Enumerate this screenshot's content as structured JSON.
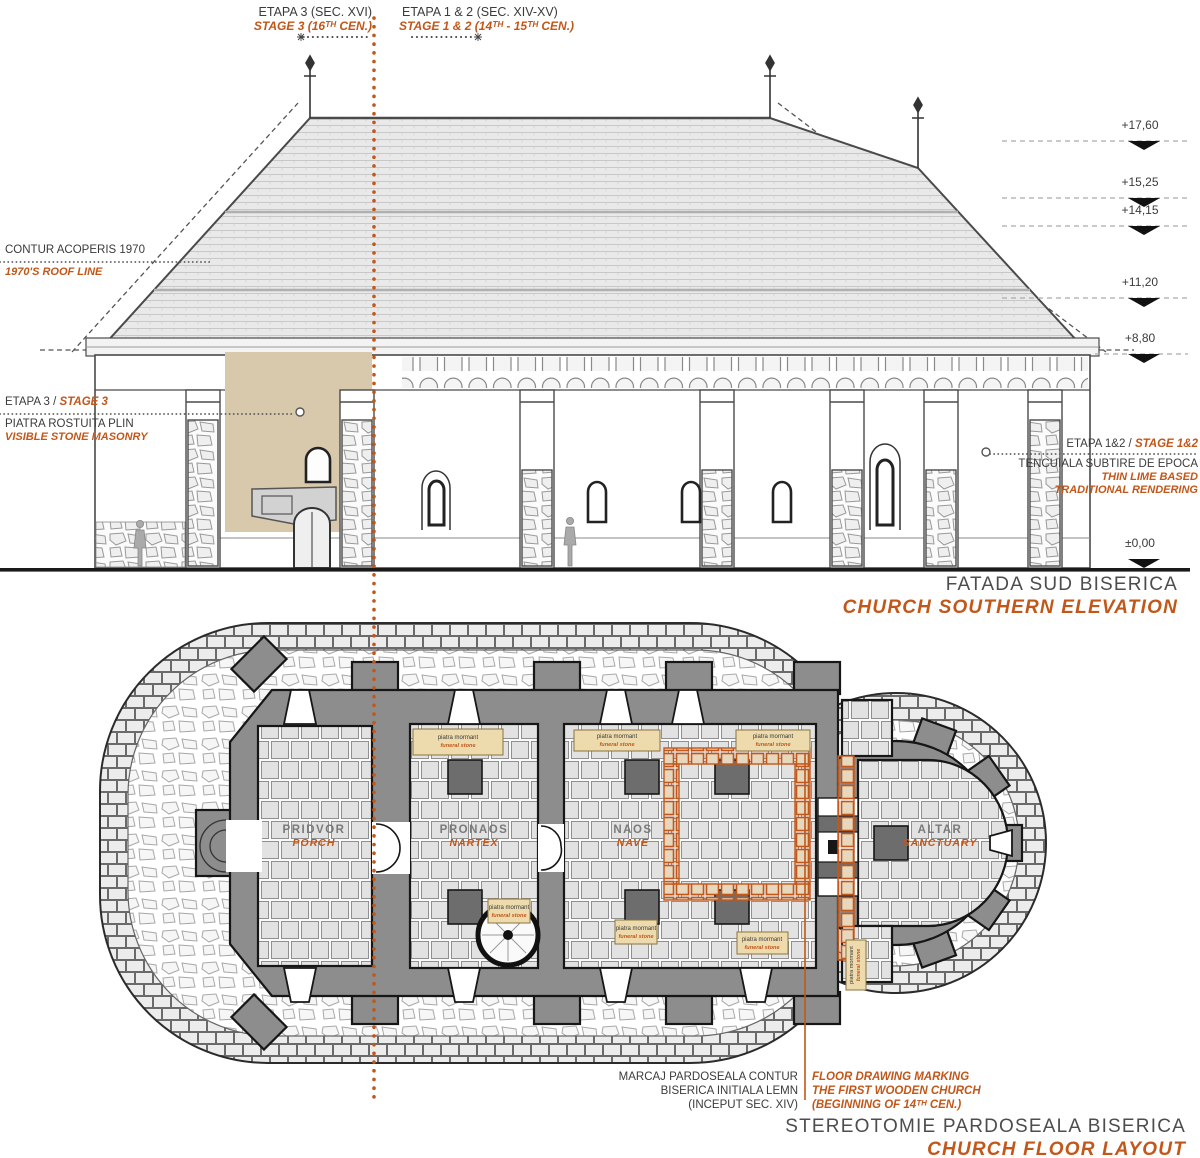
{
  "accent": "#c2571a",
  "top": {
    "left_ro": "ETAPA  3 (SEC. XVI)",
    "left_en": "STAGE 3 (16ᵀᴴ CEN.)",
    "right_ro": "ETAPA  1 & 2 (SEC. XIV-XV)",
    "right_en": "STAGE 1 & 2 (14ᵀᴴ - 15ᵀᴴ CEN.)"
  },
  "elevation": {
    "roof_label_ro": "CONTUR ACOPERIS 1970",
    "roof_label_en": "1970'S ROOF LINE",
    "stage3_ro": "ETAPA 3 / ",
    "stage3_en": "STAGE 3",
    "stage3_note_ro": "PIATRA ROSTUITA PLIN",
    "stage3_note_en": "VISIBLE STONE MASONRY",
    "stage12_ro": "ETAPA 1&2 / ",
    "stage12_en": "STAGE 1&2",
    "stage12_note_ro": "TENCUIALA SUBTIRE DE EPOCA",
    "stage12_note_en1": "THIN LIME BASED",
    "stage12_note_en2": "TRADITIONAL RENDERING",
    "levels": [
      "+17,60",
      "+15,25",
      "+14,15",
      "+11,20",
      "+8,80",
      "±0,00"
    ],
    "title_ro": "FATADA SUD BISERICA",
    "title_en": "CHURCH SOUTHERN ELEVATION"
  },
  "plan": {
    "rooms": [
      {
        "ro": "PRIDVOR",
        "en": "PORCH"
      },
      {
        "ro": "PRONAOS",
        "en": "NARTEX"
      },
      {
        "ro": "NAOS",
        "en": "NAVE"
      },
      {
        "ro": "ALTAR",
        "en": "SANCTUARY"
      }
    ],
    "funeral_stone": {
      "ro": "piatra mormant",
      "en": "funeral stone"
    },
    "marking_ro": [
      "MARCAJ PARDOSEALA CONTUR",
      "BISERICA INITIALA LEMN",
      "(INCEPUT SEC. XIV)"
    ],
    "marking_en": [
      "FLOOR DRAWING MARKING",
      "THE FIRST WOODEN CHURCH",
      "(BEGINNING OF 14ᵀᴴ CEN.)"
    ],
    "title_ro": "STEREOTOMIE PARDOSEALA BISERICA",
    "title_en": "CHURCH FLOOR LAYOUT"
  }
}
